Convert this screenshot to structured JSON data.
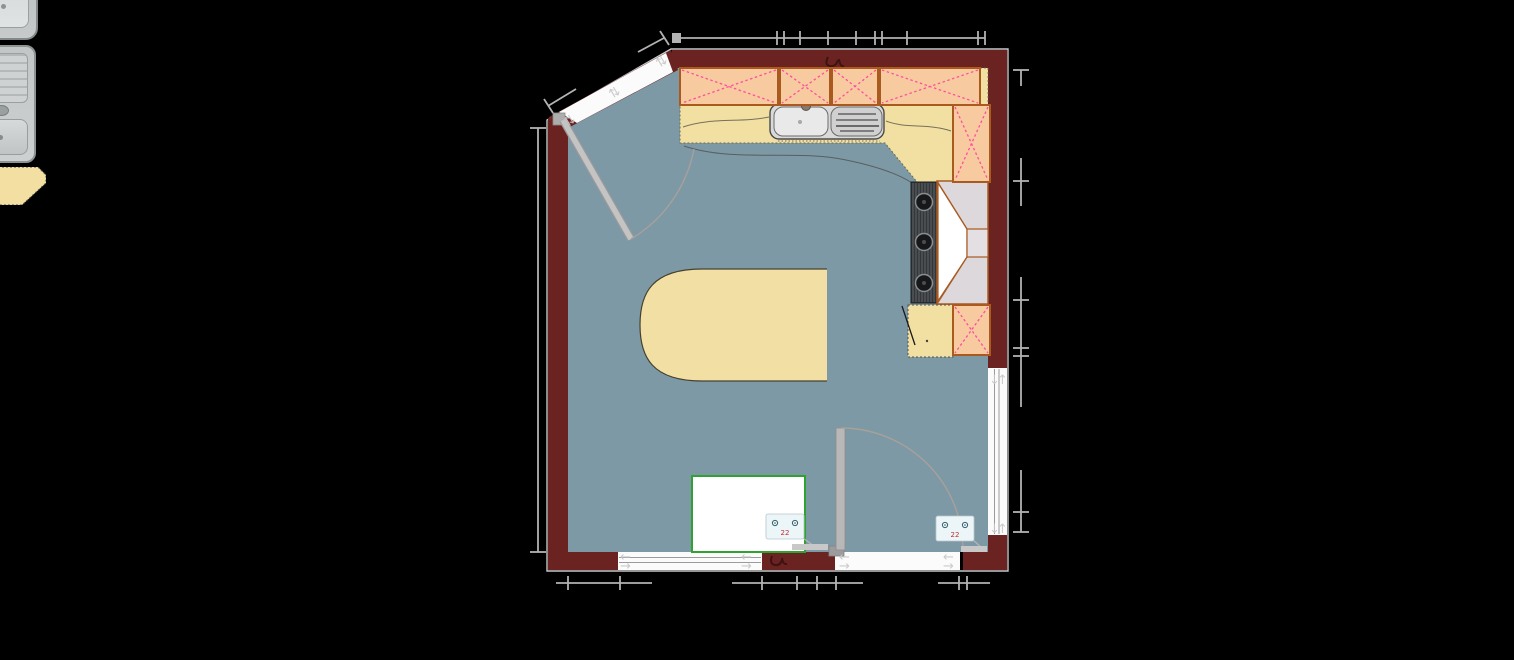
{
  "app": {
    "type": "kitchen-floor-planner-canvas",
    "background": "#000000"
  },
  "colors": {
    "wall": "#6b2322",
    "wall_outline": "#c8c8c8",
    "floor": "#7d99a6",
    "cabinet_fill": "#f8caa0",
    "cabinet_border": "#aa5a1e",
    "cabinet_cross": "#ff4da0",
    "counter_fill": "#f2dfa2",
    "counter_edge": "#55524a",
    "island_fill": "#f2dfa3",
    "dimension": "#b3b3b3",
    "door_leaf": "#b9b9b9",
    "swing_arc": "#a8a09a",
    "opening_fill": "#fbfbfb",
    "glass_line": "#9b9b9b",
    "appliance_border_green": "#2fa32f",
    "outlet_fill": "#ecf5f7",
    "sink_steel": "#d9d9d9",
    "hood_gray": "#dcd8dc",
    "hood_border": "#a85a20",
    "cooktop_dark": "#33373a"
  },
  "palette": {
    "items": [
      {
        "id": "sink-single-bowl",
        "kind": "sink object, single bowl"
      },
      {
        "id": "sink-with-drainer",
        "kind": "sink object, bowl with drainer"
      },
      {
        "id": "corner-countertop",
        "kind": "countertop corner piece"
      }
    ]
  },
  "plan": {
    "wall_cabinets": [
      {
        "x": 680,
        "y": 68,
        "w": 98,
        "h": 37
      },
      {
        "x": 780,
        "y": 68,
        "w": 50,
        "h": 37
      },
      {
        "x": 832,
        "y": 68,
        "w": 46,
        "h": 37
      },
      {
        "x": 880,
        "y": 68,
        "w": 100,
        "h": 37
      },
      {
        "x": 953,
        "y": 105,
        "w": 37,
        "h": 77
      },
      {
        "x": 953,
        "y": 305,
        "w": 37,
        "h": 50
      }
    ],
    "outlets": [
      {
        "x": 766,
        "y": 514,
        "leader": [
          803,
          538,
          814,
          546
        ],
        "bar": [
          792,
          544,
          36,
          6
        ]
      },
      {
        "x": 936,
        "y": 516,
        "leader": [
          972,
          539,
          983,
          549
        ],
        "bar": [
          961,
          546,
          26,
          6
        ]
      }
    ],
    "opening_arrows": [
      {
        "x": 620,
        "y": 561,
        "dir": "left"
      },
      {
        "x": 620,
        "y": 570,
        "dir": "right"
      },
      {
        "x": 741,
        "y": 561,
        "dir": "left"
      },
      {
        "x": 741,
        "y": 570,
        "dir": "right"
      },
      {
        "x": 839,
        "y": 561,
        "dir": "left"
      },
      {
        "x": 839,
        "y": 570,
        "dir": "right"
      },
      {
        "x": 943,
        "y": 561,
        "dir": "left"
      },
      {
        "x": 943,
        "y": 570,
        "dir": "right"
      },
      {
        "x": 989,
        "y": 384,
        "dir": "down"
      },
      {
        "x": 997,
        "y": 384,
        "dir": "up"
      },
      {
        "x": 989,
        "y": 533,
        "dir": "down"
      },
      {
        "x": 997,
        "y": 533,
        "dir": "up"
      },
      {
        "x": 567,
        "y": 127,
        "dir": "swap",
        "rot": -31
      },
      {
        "x": 612,
        "y": 99,
        "dir": "swap",
        "rot": -31
      },
      {
        "x": 659,
        "y": 68,
        "dir": "swap",
        "rot": -31
      }
    ],
    "dimensions": {
      "top": {
        "y": 38,
        "x1": 678,
        "x2": 985,
        "square": [
          672,
          33,
          9,
          10
        ],
        "ticks": [
          777,
          784,
          800,
          828,
          856,
          875,
          882,
          907,
          978,
          985
        ]
      },
      "bottom": {
        "y": 583,
        "segments": [
          [
            556,
            652
          ],
          [
            732,
            863
          ],
          [
            938,
            990
          ]
        ],
        "ticks": [
          568,
          620,
          762,
          797,
          817,
          836,
          959,
          967
        ]
      },
      "left": {
        "x": 538,
        "y1": 128,
        "y2": 552,
        "end_bars": [
          128,
          552
        ],
        "ticks": []
      },
      "right": {
        "x": 1021,
        "segments": [
          [
            70,
            86
          ],
          [
            158,
            206
          ],
          [
            277,
            407
          ],
          [
            470,
            532
          ]
        ],
        "end_bars": [
          70,
          532
        ],
        "ticks": [
          181,
          300,
          348,
          356,
          512
        ]
      },
      "diagonal_marks": [
        {
          "line": [
            548,
            106,
            576,
            89
          ],
          "bar": [
            544,
            99,
            553,
            113
          ]
        },
        {
          "line": [
            638,
            52,
            664,
            38
          ],
          "bar": [
            660,
            31,
            669,
            45
          ]
        }
      ]
    }
  }
}
